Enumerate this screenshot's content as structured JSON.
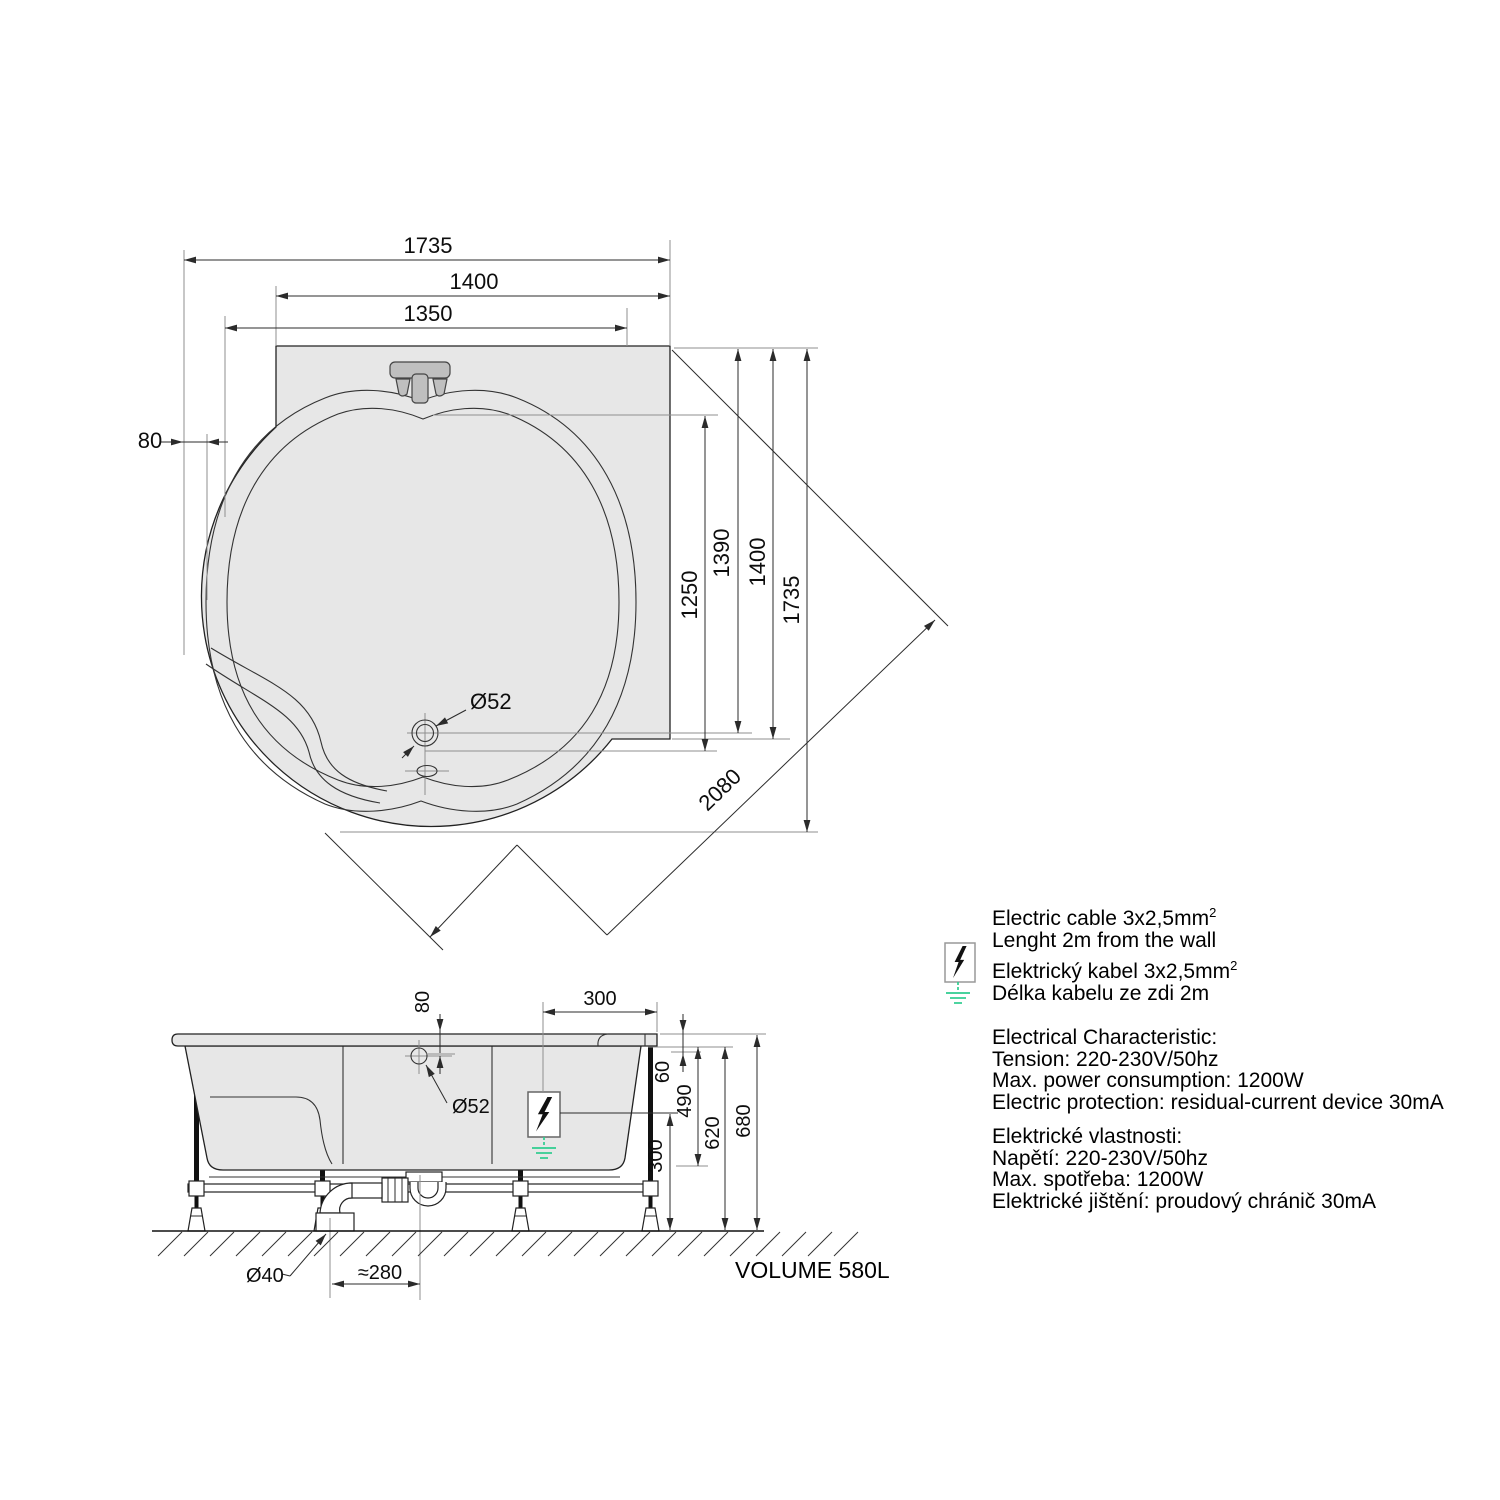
{
  "colors": {
    "background": "#ffffff",
    "fill_gray": "#e7e7e7",
    "fixture_gray": "#bfbfbf",
    "line": "#222222",
    "dim_line": "#2b2b2b",
    "ext_line": "#8f8f8f",
    "ground_green": "#2ecc8f"
  },
  "top_view": {
    "dim_top_total": "1735",
    "dim_top_deck": "1400",
    "dim_top_inner": "1350",
    "dim_left_rim": "80",
    "dim_right_1250": "1250",
    "dim_right_1390": "1390",
    "dim_right_1400": "1400",
    "dim_right_1735": "1735",
    "dim_diagonal": "2080",
    "drain_label": "Ø52"
  },
  "side_view": {
    "dim_hole_offset": "80",
    "hole_label": "Ø52",
    "dim_cable_inset": "300",
    "dim_rim": "60",
    "dim_490": "490",
    "dim_620": "620",
    "dim_680": "680",
    "dim_cable_height": "300",
    "waste_label": "Ø40",
    "dim_trap_offset": "≈280",
    "volume_label": "VOLUME 580L"
  },
  "notes": {
    "cable_en_line1": "Electric cable 3x2,5mm",
    "cable_en_sup": "2",
    "cable_en_line2": "Lenght 2m from the wall",
    "cable_cz_line1": "Elektrický kabel 3x2,5mm",
    "cable_cz_sup": "2",
    "cable_cz_line2": "Délka kabelu ze zdi 2m",
    "electrical_en": [
      "Electrical Characteristic:",
      "Tension: 220-230V/50hz",
      "Max. power consumption: 1200W",
      "Electric protection: residual-current device 30mA"
    ],
    "electrical_cz": [
      "Elektrické vlastnosti:",
      "Napětí: 220-230V/50hz",
      "Max. spotřeba: 1200W",
      "Elektrické jištění: proudový chránič 30mA"
    ]
  }
}
